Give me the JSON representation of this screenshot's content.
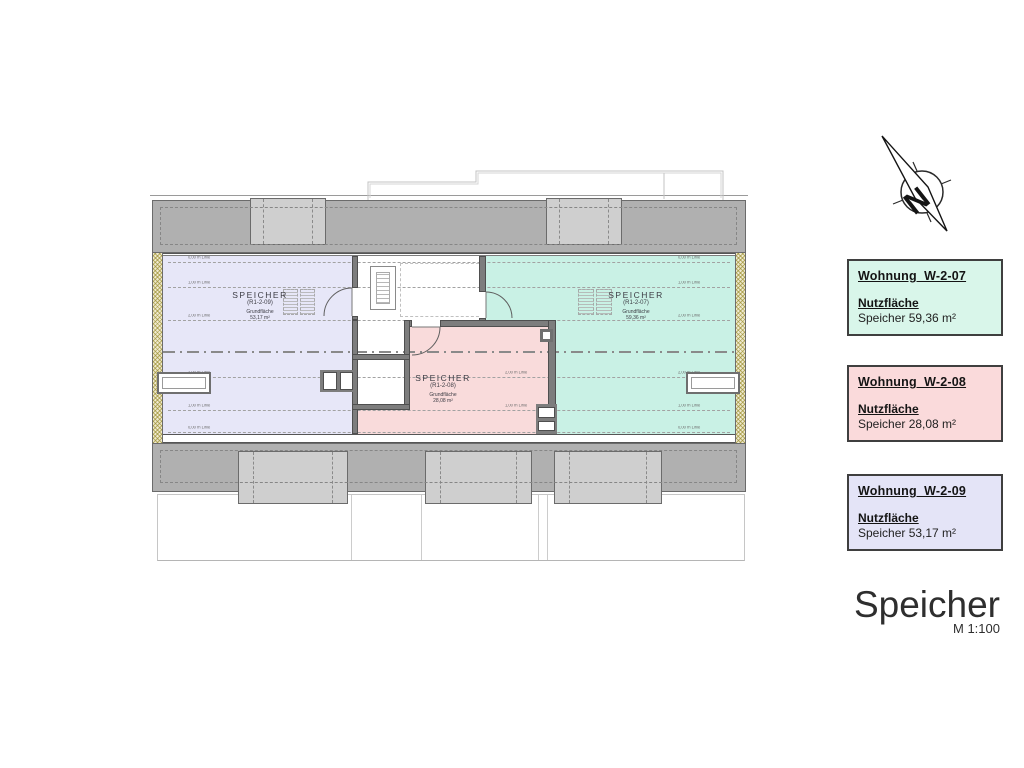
{
  "plan": {
    "rooms": [
      {
        "name": "SPEICHER",
        "id": "(R1-2-09)",
        "area_label": "Grundfläche",
        "area": "53,17 m²"
      },
      {
        "name": "SPEICHER",
        "id": "(R1-2-08)",
        "area_label": "Grundfläche",
        "area": "28,08 m²"
      },
      {
        "name": "SPEICHER",
        "id": "(R1-2-07)",
        "area_label": "Grundfläche",
        "area": "59,36 m²"
      }
    ],
    "height_lines": [
      "0,00 m Linie",
      "1,00 m Linie",
      "2,00 m Linie",
      "2,00 m Linie",
      "1,00 m Linie",
      "0,00 m Linie"
    ]
  },
  "legend": [
    {
      "title": "Wohnung  W-2-07",
      "section": "Nutzfläche",
      "value": "Speicher 59,36 m²",
      "bg": "#d9f6ea"
    },
    {
      "title": "Wohnung  W-2-08",
      "section": "Nutzfläche",
      "value": "Speicher 28,08 m²",
      "bg": "#fadadb"
    },
    {
      "title": "Wohnung  W-2-09",
      "section": "Nutzfläche",
      "value": "Speicher 53,17 m²",
      "bg": "#e4e4f7"
    }
  ],
  "title_block": {
    "title": "Speicher",
    "scale": "M 1:100"
  },
  "compass": {
    "label": "N"
  },
  "colors": {
    "room_w209": "#e7e7f8",
    "room_w208": "#f9dbdb",
    "room_w207": "#c9f1e5",
    "roof": "#b0b0b0",
    "dormer": "#cfcfcf",
    "wall": "#7d7d7d",
    "hatch": "#968a28"
  }
}
